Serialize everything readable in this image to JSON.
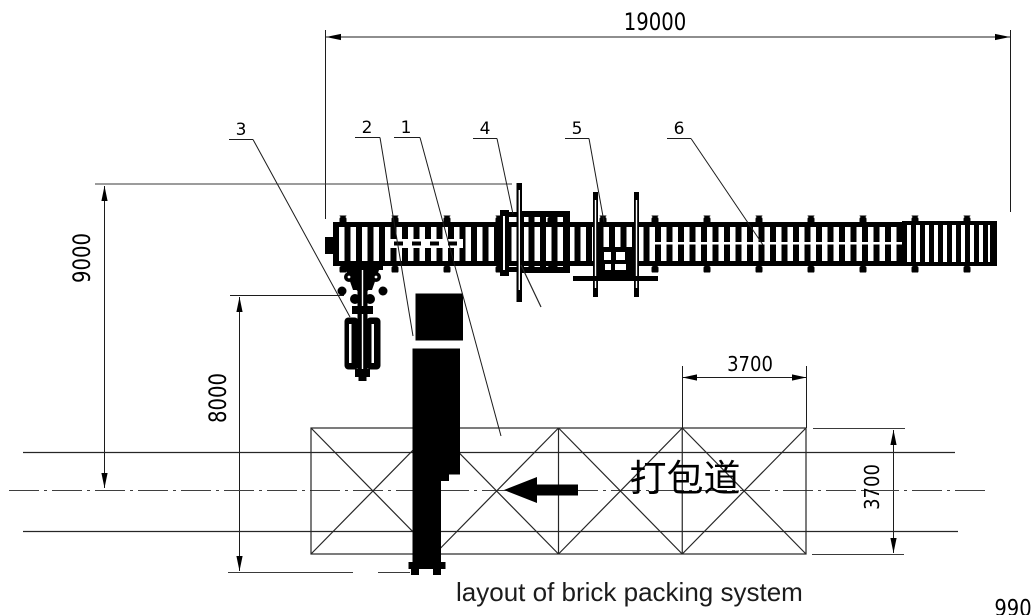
{
  "drawing": {
    "caption": "layout of brick packing system",
    "sheet_number": "990",
    "lane_label": "打包道",
    "dimensions": {
      "overall_length": "19000",
      "height_to_centerline": "9000",
      "height_to_lane_bottom": "8000",
      "truss_bay_width": "3700",
      "lane_width": "3700"
    },
    "callouts": [
      {
        "label": "3"
      },
      {
        "label": "2"
      },
      {
        "label": "1"
      },
      {
        "label": "4"
      },
      {
        "label": "5"
      },
      {
        "label": "6"
      }
    ],
    "flow_arrow": {
      "direction": "left"
    },
    "colors": {
      "ink": "#000000",
      "thin_line": "#3a3a3a",
      "background": "#ffffff"
    }
  }
}
